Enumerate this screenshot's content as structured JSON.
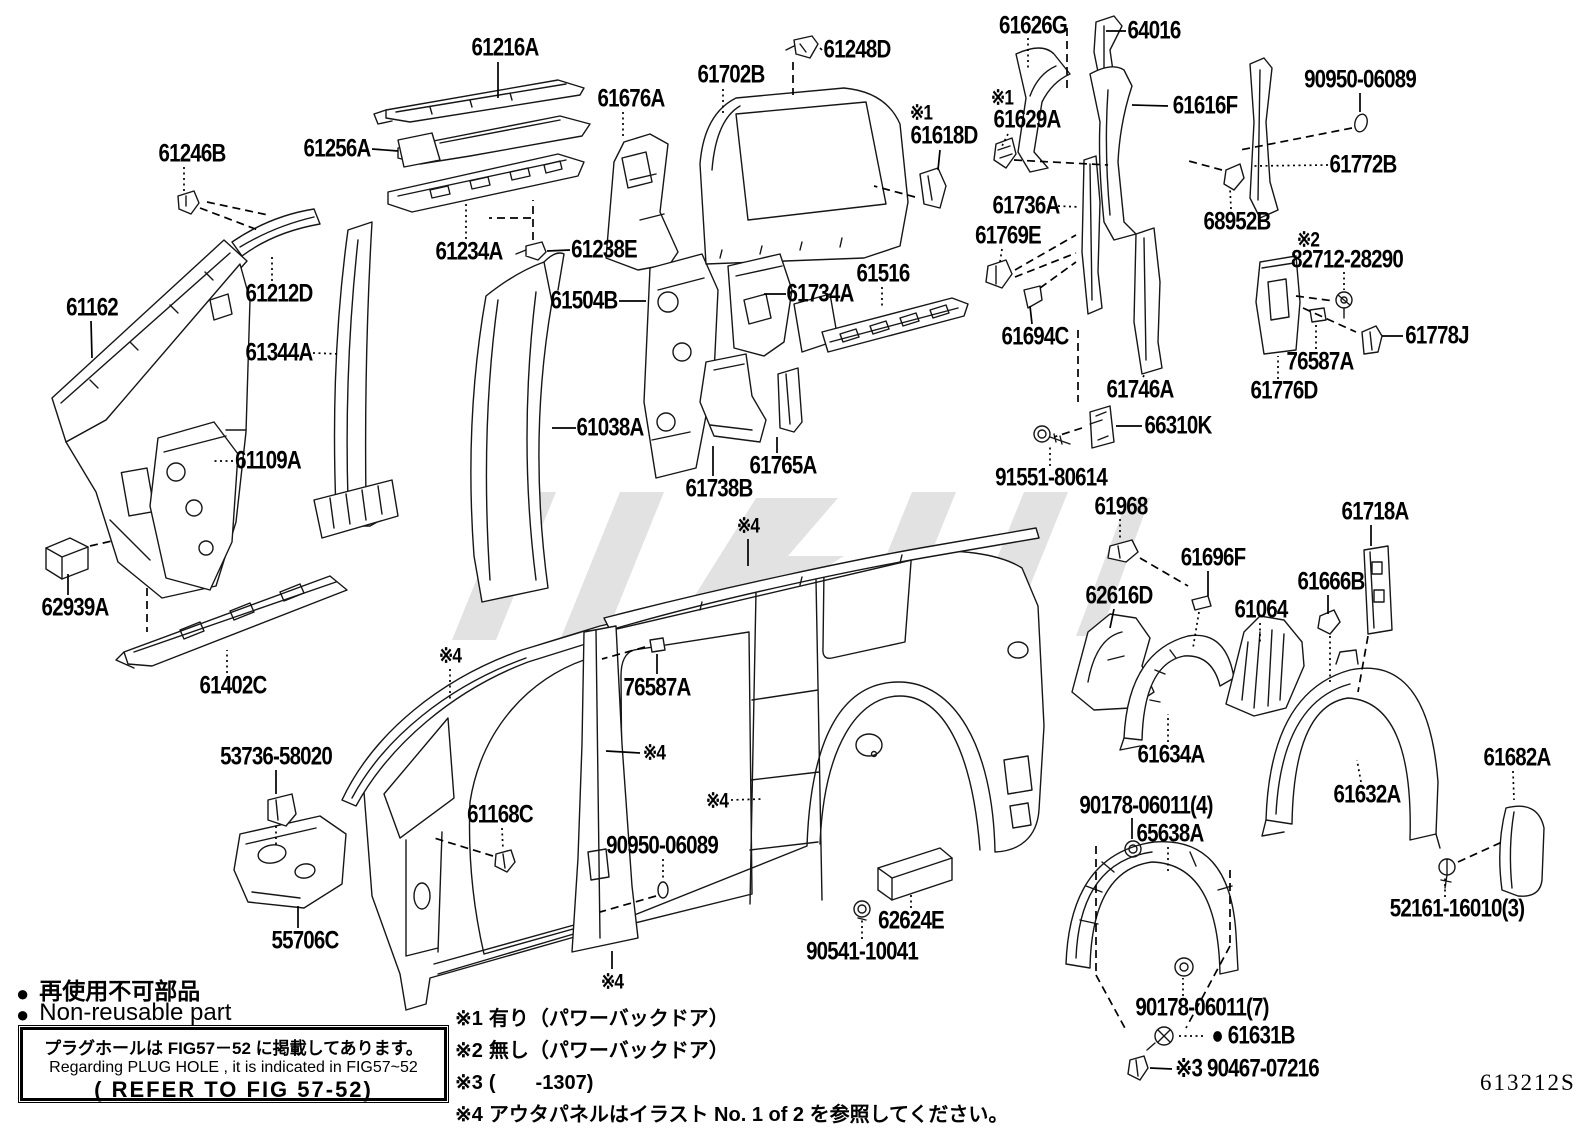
{
  "page": {
    "bg": "#ffffff",
    "ink": "#000000",
    "watermark_color": "#c6c6c6",
    "diagram_code": "613212S"
  },
  "legend": {
    "bullet": "●",
    "ja": "再使用不可部品",
    "en": "Non-reusable part"
  },
  "plug_note": {
    "ja": "プラグホールは FIG57－52 に掲載してあります。",
    "en": "Regarding PLUG HOLE , it is indicated in FIG57~52",
    "ref": "( REFER TO FIG 57-52)"
  },
  "footnotes": [
    {
      "mark": "※1",
      "text": "有り（パワーバックドア）"
    },
    {
      "mark": "※2",
      "text": "無し（パワーバックドア）"
    },
    {
      "mark": "※3",
      "text": "(　　-1307)"
    },
    {
      "mark": "※4",
      "text": "アウタパネルはイラスト No. 1 of 2 を参照してください。"
    }
  ],
  "labels": [
    {
      "n": "part-label-61216a",
      "t": "61216A",
      "x": 505,
      "y": 48,
      "ln": [
        [
          498,
          62,
          498,
          98,
          "s"
        ]
      ]
    },
    {
      "n": "part-label-61248d",
      "t": "61248D",
      "x": 857,
      "y": 50,
      "ln": [
        [
          822,
          50,
          820,
          48,
          "s"
        ],
        [
          793,
          62,
          793,
          95,
          "d"
        ]
      ]
    },
    {
      "n": "part-label-61702b",
      "t": "61702B",
      "x": 731,
      "y": 75,
      "ln": [
        [
          723,
          89,
          723,
          114,
          "t"
        ]
      ]
    },
    {
      "n": "part-label-61676a",
      "t": "61676A",
      "x": 631,
      "y": 99,
      "ln": [
        [
          623,
          112,
          623,
          138,
          "t"
        ]
      ]
    },
    {
      "n": "part-label-61626g",
      "t": "61626G",
      "x": 1033,
      "y": 26,
      "ln": [
        [
          1028,
          38,
          1028,
          68,
          "t"
        ],
        [
          1067,
          28,
          1067,
          92,
          "d"
        ]
      ]
    },
    {
      "n": "part-label-64016",
      "t": "64016",
      "x": 1154,
      "y": 31,
      "ln": [
        [
          1126,
          31,
          1106,
          31,
          "s"
        ]
      ]
    },
    {
      "n": "part-label-90950-06089-top",
      "t": "90950-06089",
      "x": 1360,
      "y": 80,
      "ln": [
        [
          1360,
          93,
          1360,
          112,
          "s"
        ],
        [
          1352,
          128,
          1240,
          150,
          "d"
        ]
      ]
    },
    {
      "n": "part-label-61246b",
      "t": "61246B",
      "x": 192,
      "y": 154,
      "ln": [
        [
          184,
          167,
          184,
          193,
          "t"
        ],
        [
          200,
          208,
          258,
          230,
          "d"
        ],
        [
          207,
          202,
          268,
          215,
          "d"
        ]
      ]
    },
    {
      "n": "part-label-61256a",
      "t": "61256A",
      "x": 337,
      "y": 149,
      "ln": [
        [
          372,
          149,
          398,
          151,
          "s"
        ]
      ]
    },
    {
      "n": "part-label-61616f",
      "t": "61616F",
      "x": 1205,
      "y": 106,
      "ln": [
        [
          1168,
          106,
          1132,
          105,
          "s"
        ]
      ]
    },
    {
      "n": "part-label-mark1-61618d",
      "t": "※1",
      "x": 921,
      "y": 113,
      "sm": 1
    },
    {
      "n": "part-label-61618d",
      "t": "61618D",
      "x": 944,
      "y": 136,
      "ln": [
        [
          940,
          150,
          938,
          170,
          "s"
        ],
        [
          915,
          197,
          874,
          186,
          "d"
        ]
      ]
    },
    {
      "n": "part-label-mark1-61629a",
      "t": "※1",
      "x": 1002,
      "y": 98,
      "sm": 1
    },
    {
      "n": "part-label-61629a",
      "t": "61629A",
      "x": 1027,
      "y": 120,
      "ln": [
        [
          1008,
          134,
          1002,
          146,
          "t"
        ],
        [
          1014,
          160,
          1108,
          165,
          "d"
        ]
      ]
    },
    {
      "n": "part-label-61772b",
      "t": "61772B",
      "x": 1363,
      "y": 165,
      "ln": [
        [
          1328,
          165,
          1252,
          166,
          "t"
        ]
      ]
    },
    {
      "n": "part-label-68952b",
      "t": "68952B",
      "x": 1237,
      "y": 222,
      "ln": [
        [
          1231,
          209,
          1230,
          188,
          "t"
        ],
        [
          1222,
          170,
          1185,
          160,
          "d"
        ]
      ]
    },
    {
      "n": "part-label-mark2",
      "t": "※2",
      "x": 1308,
      "y": 240,
      "sm": 1
    },
    {
      "n": "part-label-82712-28290",
      "t": "82712-28290",
      "x": 1347,
      "y": 260,
      "ln": [
        [
          1344,
          272,
          1344,
          290,
          "t"
        ],
        [
          1296,
          296,
          1334,
          301,
          "d"
        ],
        [
          1303,
          308,
          1356,
          332,
          "d"
        ]
      ]
    },
    {
      "n": "part-label-61736a",
      "t": "61736A",
      "x": 1026,
      "y": 206,
      "ln": [
        [
          1058,
          206,
          1080,
          207,
          "t"
        ]
      ]
    },
    {
      "n": "part-label-61769e",
      "t": "61769E",
      "x": 1008,
      "y": 236,
      "ln": [
        [
          1002,
          249,
          1000,
          262,
          "t"
        ],
        [
          1015,
          270,
          1076,
          235,
          "d"
        ],
        [
          1015,
          277,
          1076,
          253,
          "d"
        ]
      ]
    },
    {
      "n": "part-label-61234a",
      "t": "61234A",
      "x": 469,
      "y": 252,
      "ln": [
        [
          466,
          239,
          466,
          204,
          "t"
        ]
      ]
    },
    {
      "n": "part-label-61238e",
      "t": "61238E",
      "x": 604,
      "y": 250,
      "ln": [
        [
          570,
          250,
          547,
          251,
          "s"
        ],
        [
          533,
          240,
          533,
          200,
          "d"
        ],
        [
          531,
          218,
          489,
          218,
          "d"
        ]
      ]
    },
    {
      "n": "part-label-61212d",
      "t": "61212D",
      "x": 279,
      "y": 294,
      "ln": [
        [
          272,
          281,
          272,
          256,
          "t"
        ]
      ]
    },
    {
      "n": "part-label-61162",
      "t": "61162",
      "x": 92,
      "y": 308,
      "ln": [
        [
          91,
          321,
          92,
          358,
          "s"
        ]
      ]
    },
    {
      "n": "part-label-61504b",
      "t": "61504B",
      "x": 584,
      "y": 301,
      "ln": [
        [
          619,
          301,
          646,
          301,
          "s"
        ]
      ]
    },
    {
      "n": "part-label-61734a",
      "t": "61734A",
      "x": 820,
      "y": 294,
      "ln": [
        [
          786,
          294,
          764,
          294,
          "s"
        ]
      ]
    },
    {
      "n": "part-label-61516",
      "t": "61516",
      "x": 883,
      "y": 274,
      "ln": [
        [
          882,
          287,
          882,
          306,
          "t"
        ]
      ]
    },
    {
      "n": "part-label-61694c",
      "t": "61694C",
      "x": 1035,
      "y": 337,
      "ln": [
        [
          1032,
          324,
          1030,
          306,
          "s"
        ],
        [
          1040,
          288,
          1076,
          262,
          "d"
        ]
      ]
    },
    {
      "n": "part-label-61344a",
      "t": "61344A",
      "x": 279,
      "y": 353,
      "ln": [
        [
          313,
          353,
          340,
          354,
          "t"
        ]
      ]
    },
    {
      "n": "part-label-61746a",
      "t": "61746A",
      "x": 1140,
      "y": 390,
      "ln": [
        [
          1143,
          377,
          1145,
          374,
          "t"
        ]
      ]
    },
    {
      "n": "part-label-76587a-right",
      "t": "76587A",
      "x": 1320,
      "y": 362,
      "ln": [
        [
          1316,
          349,
          1316,
          324,
          "t"
        ]
      ]
    },
    {
      "n": "part-label-61776d",
      "t": "61776D",
      "x": 1284,
      "y": 391,
      "ln": [
        [
          1278,
          379,
          1278,
          356,
          "t"
        ]
      ]
    },
    {
      "n": "part-label-61778j",
      "t": "61778J",
      "x": 1437,
      "y": 336,
      "ln": [
        [
          1403,
          336,
          1382,
          336,
          "s"
        ]
      ]
    },
    {
      "n": "part-label-66310k",
      "t": "66310K",
      "x": 1178,
      "y": 426,
      "ln": [
        [
          1142,
          426,
          1116,
          426,
          "s"
        ],
        [
          1082,
          428,
          1054,
          437,
          "d"
        ],
        [
          1078,
          330,
          1078,
          402,
          "d"
        ]
      ]
    },
    {
      "n": "part-label-91551-80614",
      "t": "91551-80614",
      "x": 1051,
      "y": 478,
      "ln": [
        [
          1050,
          466,
          1050,
          446,
          "t"
        ]
      ]
    },
    {
      "n": "part-label-61968",
      "t": "61968",
      "x": 1121,
      "y": 507,
      "ln": [
        [
          1120,
          519,
          1120,
          540,
          "t"
        ],
        [
          1140,
          558,
          1188,
          586,
          "d"
        ]
      ]
    },
    {
      "n": "part-label-61718a",
      "t": "61718A",
      "x": 1375,
      "y": 512,
      "ln": [
        [
          1371,
          525,
          1371,
          546,
          "s"
        ],
        [
          1368,
          636,
          1358,
          692,
          "d"
        ]
      ]
    },
    {
      "n": "part-label-61696f",
      "t": "61696F",
      "x": 1213,
      "y": 558,
      "ln": [
        [
          1208,
          571,
          1208,
          596,
          "s"
        ],
        [
          1199,
          612,
          1193,
          648,
          "t"
        ]
      ]
    },
    {
      "n": "part-label-61666b",
      "t": "61666B",
      "x": 1331,
      "y": 582,
      "ln": [
        [
          1328,
          595,
          1328,
          614,
          "s"
        ],
        [
          1330,
          636,
          1330,
          682,
          "t"
        ]
      ]
    },
    {
      "n": "part-label-62616d",
      "t": "62616D",
      "x": 1119,
      "y": 596,
      "ln": [
        [
          1114,
          609,
          1110,
          628,
          "s"
        ]
      ]
    },
    {
      "n": "part-label-61064",
      "t": "61064",
      "x": 1261,
      "y": 610,
      "ln": [
        [
          1260,
          623,
          1260,
          645,
          "t"
        ]
      ]
    },
    {
      "n": "part-label-61634a",
      "t": "61634A",
      "x": 1171,
      "y": 755,
      "ln": [
        [
          1168,
          742,
          1168,
          714,
          "t"
        ]
      ]
    },
    {
      "n": "part-label-61632a",
      "t": "61632A",
      "x": 1367,
      "y": 795,
      "ln": [
        [
          1361,
          782,
          1357,
          760,
          "t"
        ]
      ]
    },
    {
      "n": "part-label-61682a",
      "t": "61682A",
      "x": 1517,
      "y": 758,
      "ln": [
        [
          1513,
          771,
          1514,
          800,
          "t"
        ]
      ]
    },
    {
      "n": "part-label-52161-16010",
      "t": "52161-16010(3)",
      "x": 1457,
      "y": 909,
      "ln": [
        [
          1445,
          897,
          1445,
          877,
          "t"
        ],
        [
          1458,
          862,
          1502,
          842,
          "d"
        ]
      ]
    },
    {
      "n": "part-label-65638a",
      "t": "65638A",
      "x": 1170,
      "y": 834,
      "ln": [
        [
          1168,
          847,
          1168,
          872,
          "t"
        ]
      ]
    },
    {
      "n": "part-label-90178-06011-4",
      "t": "90178-06011(4)",
      "x": 1146,
      "y": 806,
      "ln": [
        [
          1132,
          818,
          1132,
          839,
          "s"
        ],
        [
          1096,
          846,
          1096,
          975,
          "d"
        ],
        [
          1096,
          975,
          1126,
          1030,
          "d"
        ],
        [
          1230,
          870,
          1230,
          946,
          "d"
        ],
        [
          1230,
          946,
          1186,
          1028,
          "d"
        ]
      ]
    },
    {
      "n": "part-label-90178-06011-7",
      "t": "90178-06011(7)",
      "x": 1202,
      "y": 1008,
      "ln": [
        [
          1183,
          996,
          1183,
          978,
          "t"
        ]
      ]
    },
    {
      "n": "part-label-61631b",
      "t": "● 61631B",
      "x": 1253,
      "y": 1036,
      "ln": [
        [
          1203,
          1036,
          1177,
          1036,
          "t"
        ]
      ]
    },
    {
      "n": "part-label-90467-07216",
      "t": "※3 90467-07216",
      "x": 1247,
      "y": 1069,
      "ln": [
        [
          1172,
          1069,
          1150,
          1068,
          "s"
        ]
      ]
    },
    {
      "n": "part-label-62624e",
      "t": "62624E",
      "x": 911,
      "y": 921,
      "ln": [
        [
          911,
          908,
          911,
          892,
          "t"
        ]
      ]
    },
    {
      "n": "part-label-90541-10041",
      "t": "90541-10041",
      "x": 862,
      "y": 952,
      "ln": [
        [
          862,
          939,
          862,
          920,
          "t"
        ]
      ]
    },
    {
      "n": "part-label-90950-06089-bottom",
      "t": "90950-06089",
      "x": 662,
      "y": 846,
      "ln": [
        [
          663,
          859,
          663,
          880,
          "t"
        ],
        [
          656,
          896,
          600,
          912,
          "d"
        ]
      ]
    },
    {
      "n": "part-label-61168c",
      "t": "61168C",
      "x": 500,
      "y": 815,
      "ln": [
        [
          502,
          828,
          503,
          850,
          "t"
        ],
        [
          493,
          856,
          434,
          838,
          "d"
        ]
      ]
    },
    {
      "n": "part-label-76587a-center",
      "t": "76587A",
      "x": 657,
      "y": 688,
      "ln": [
        [
          657,
          674,
          657,
          654,
          "s"
        ],
        [
          645,
          647,
          602,
          659,
          "d"
        ]
      ]
    },
    {
      "n": "part-label-mark4-roof",
      "t": "※4",
      "x": 748,
      "y": 526,
      "sm": 1,
      "ln": [
        [
          748,
          539,
          748,
          566,
          "s"
        ]
      ]
    },
    {
      "n": "part-label-mark4-apillar",
      "t": "※4",
      "x": 450,
      "y": 656,
      "sm": 1,
      "ln": [
        [
          450,
          669,
          450,
          700,
          "t"
        ]
      ]
    },
    {
      "n": "part-label-mark4-bpillar",
      "t": "※4",
      "x": 654,
      "y": 753,
      "sm": 1,
      "ln": [
        [
          640,
          753,
          606,
          751,
          "s"
        ]
      ]
    },
    {
      "n": "part-label-mark4-cpillar",
      "t": "※4",
      "x": 717,
      "y": 801,
      "sm": 1,
      "ln": [
        [
          731,
          800,
          762,
          799,
          "t"
        ]
      ]
    },
    {
      "n": "part-label-mark4-rocker",
      "t": "※4",
      "x": 612,
      "y": 982,
      "sm": 1,
      "ln": [
        [
          612,
          969,
          612,
          951,
          "s"
        ]
      ]
    },
    {
      "n": "part-label-61038a",
      "t": "61038A",
      "x": 610,
      "y": 428,
      "ln": [
        [
          576,
          428,
          552,
          428,
          "s"
        ]
      ]
    },
    {
      "n": "part-label-61738b",
      "t": "61738B",
      "x": 719,
      "y": 489,
      "ln": [
        [
          713,
          476,
          713,
          446,
          "s"
        ]
      ]
    },
    {
      "n": "part-label-61765a",
      "t": "61765A",
      "x": 783,
      "y": 466,
      "ln": [
        [
          777,
          453,
          777,
          437,
          "s"
        ]
      ]
    },
    {
      "n": "part-label-61109a",
      "t": "61109A",
      "x": 268,
      "y": 461,
      "ln": [
        [
          233,
          461,
          212,
          461,
          "t"
        ]
      ]
    },
    {
      "n": "part-label-62939a",
      "t": "62939A",
      "x": 75,
      "y": 608,
      "ln": [
        [
          68,
          595,
          68,
          574,
          "s"
        ],
        [
          90,
          546,
          112,
          541,
          "d"
        ]
      ]
    },
    {
      "n": "part-label-61402c",
      "t": "61402C",
      "x": 233,
      "y": 686,
      "ln": [
        [
          227,
          673,
          227,
          650,
          "t"
        ],
        [
          147,
          588,
          147,
          632,
          "d"
        ]
      ]
    },
    {
      "n": "part-label-53736-58020",
      "t": "53736-58020",
      "x": 276,
      "y": 757,
      "ln": [
        [
          276,
          770,
          276,
          794,
          "s"
        ],
        [
          276,
          826,
          276,
          846,
          "t"
        ]
      ]
    },
    {
      "n": "part-label-55706c",
      "t": "55706C",
      "x": 305,
      "y": 941,
      "ln": [
        [
          298,
          928,
          298,
          906,
          "s"
        ]
      ]
    }
  ]
}
